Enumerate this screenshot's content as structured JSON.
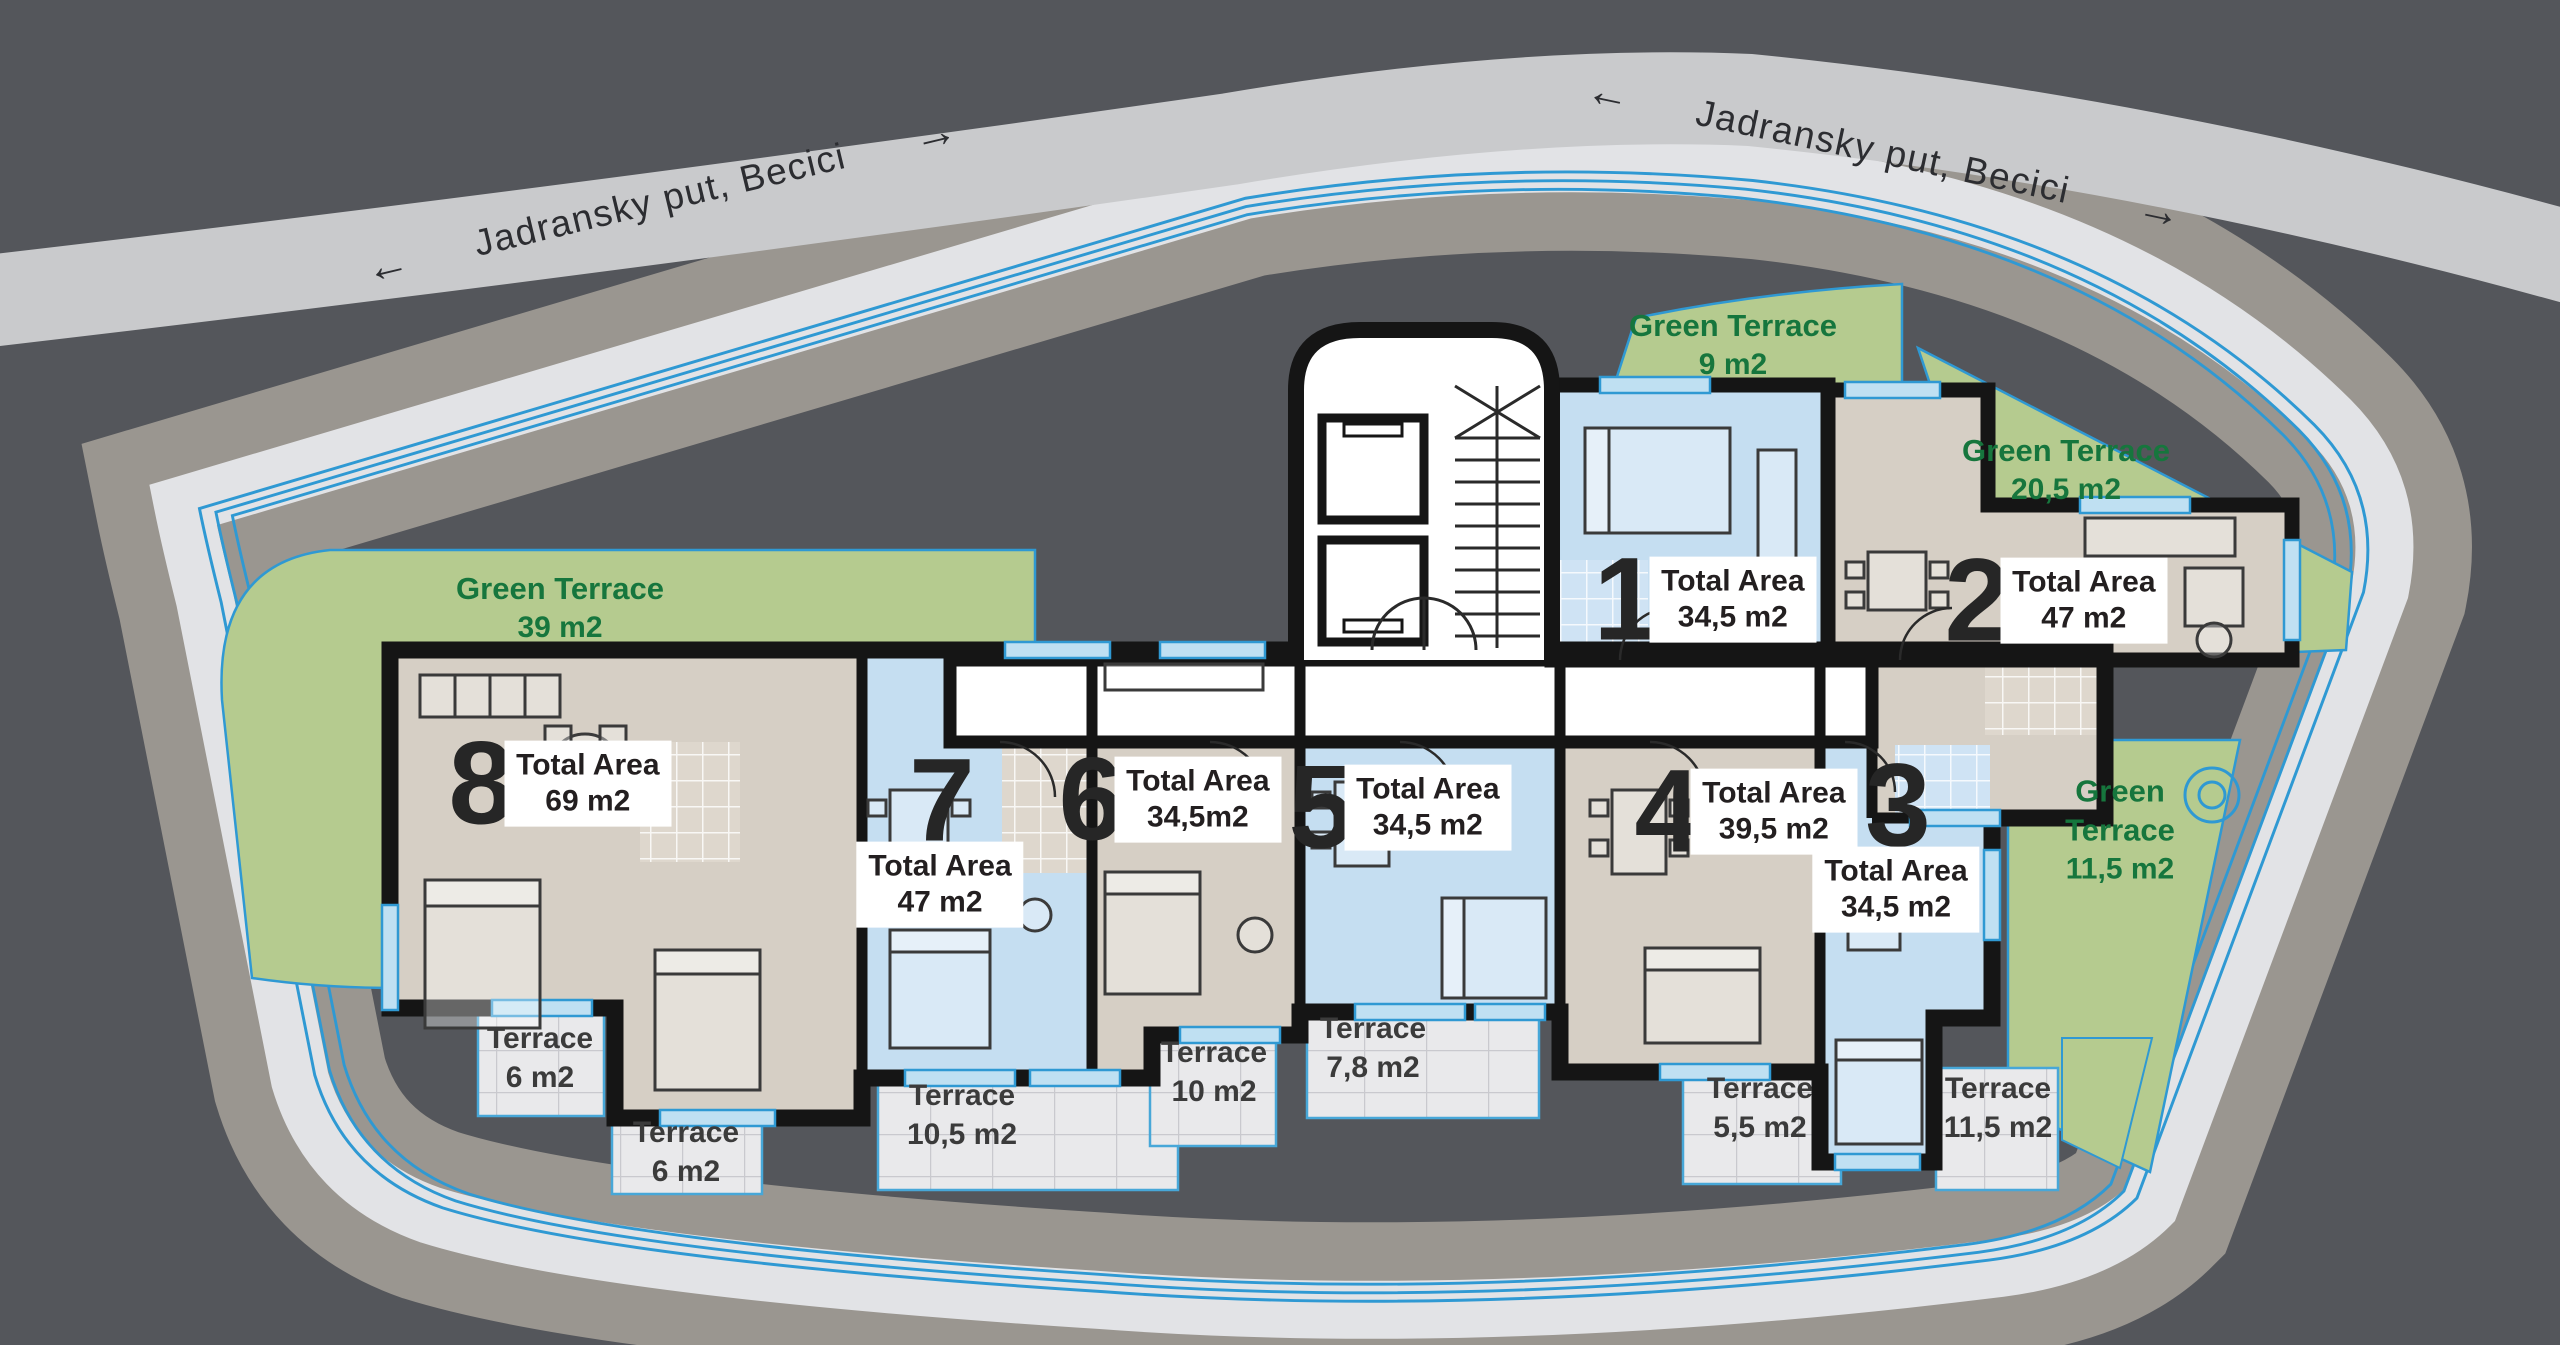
{
  "plan_title": "Residential floor plan",
  "roads": {
    "top_left": {
      "label": "Jadransky put, Becici",
      "arrow_left": "←",
      "arrow_right": "→"
    },
    "top_right": {
      "label": "Jadransky put, Becici",
      "arrow_left": "←",
      "arrow_right": "→"
    }
  },
  "green_terraces": [
    {
      "label": "Green Terrace",
      "area": "39 m2"
    },
    {
      "label": "Green Terrace",
      "area": "9 m2"
    },
    {
      "label": "Green Terrace",
      "area": "20,5 m2"
    },
    {
      "label": "Green Terrace",
      "area": "11,5 m2"
    }
  ],
  "apartments": [
    {
      "number": "1",
      "area_label": "Total Area",
      "area": "34,5 m2"
    },
    {
      "number": "2",
      "area_label": "Total Area",
      "area": "47 m2"
    },
    {
      "number": "3",
      "area_label": "Total Area",
      "area": "34,5 m2"
    },
    {
      "number": "4",
      "area_label": "Total Area",
      "area": "39,5 m2"
    },
    {
      "number": "5",
      "area_label": "Total Area",
      "area": "34,5 m2"
    },
    {
      "number": "6",
      "area_label": "Total Area",
      "area": "34,5m2"
    },
    {
      "number": "7",
      "area_label": "Total Area",
      "area": "47 m2"
    },
    {
      "number": "8",
      "area_label": "Total Area",
      "area": "69 m2"
    }
  ],
  "terraces": [
    {
      "label": "Terrace",
      "area": "6 m2"
    },
    {
      "label": "Terrace",
      "area": "6 m2"
    },
    {
      "label": "Terrace",
      "area": "10,5 m2"
    },
    {
      "label": "Terrace",
      "area": "10 m2"
    },
    {
      "label": "Terrace",
      "area": "7,8 m2"
    },
    {
      "label": "Terrace",
      "area": "5,5 m2"
    },
    {
      "label": "Terrace",
      "area": "11,5 m2"
    }
  ],
  "palette": {
    "background": "#54565b",
    "road": "#c9cacc",
    "ground_band": "#9a9690",
    "site_shadow": "#e2e3e6",
    "site": "#ffffff",
    "boundary_blue": "#2f99d3",
    "green": "#b5cb8f",
    "green_text": "#16763d",
    "room_beige": "#d6cfc5",
    "room_blue": "#c5def1",
    "terrace_tile": "#e9e9eb",
    "wall": "#151515",
    "label_text": "#231f20"
  }
}
